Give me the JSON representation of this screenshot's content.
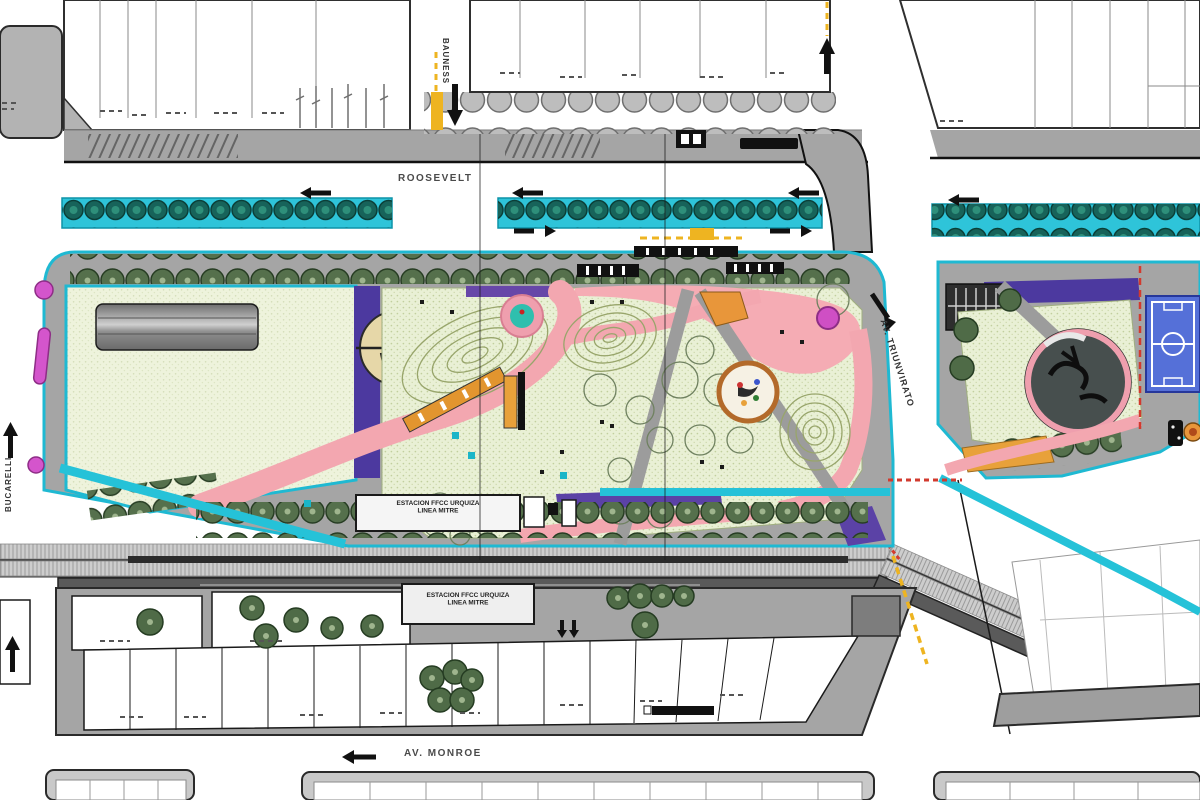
{
  "plan": {
    "type": "urban park master plan",
    "streets": {
      "roosevelt": "ROOSEVELT",
      "bauness": "BAUNESS",
      "bucarelli": "BUCARELLI",
      "triunvirato": "AV. TRIUNVIRATO",
      "monroe": "AV. MONROE"
    },
    "labels": {
      "station_platform": {
        "line1": "ESTACION FFCC URQUIZA",
        "line2": "LINEA MITRE"
      },
      "station_building": {
        "line1": "ESTACION FFCC URQUIZA",
        "line2": "LINEA MITRE"
      }
    },
    "icons": {
      "traffic_arrow": "black directional arrow (triangle head + stem)",
      "tree": "green circle tree symbol",
      "street_tree_row": "row of teal tree circles on cyan band",
      "bike_lane": "yellow dashed line",
      "railway": "hatched track band"
    },
    "colors": {
      "park_outline_cyan": "#1fb9d2",
      "tree_band_cyan": "#2ec4d9",
      "lawn_green": "#edf3da",
      "path_pink": "#f3a7b0",
      "accent_purple": "#4c399f",
      "accent_magenta": "#cf4fc4",
      "sports_field_blue": "#5570d8",
      "bike_lane_yellow": "#eeb421",
      "warning_red": "#d23a2e",
      "asphalt_gray": "#a5a5a5",
      "rail_platform_gray": "#5a5a5a",
      "tree_green": "#4f6b47",
      "play_orange": "#e8963a"
    }
  }
}
